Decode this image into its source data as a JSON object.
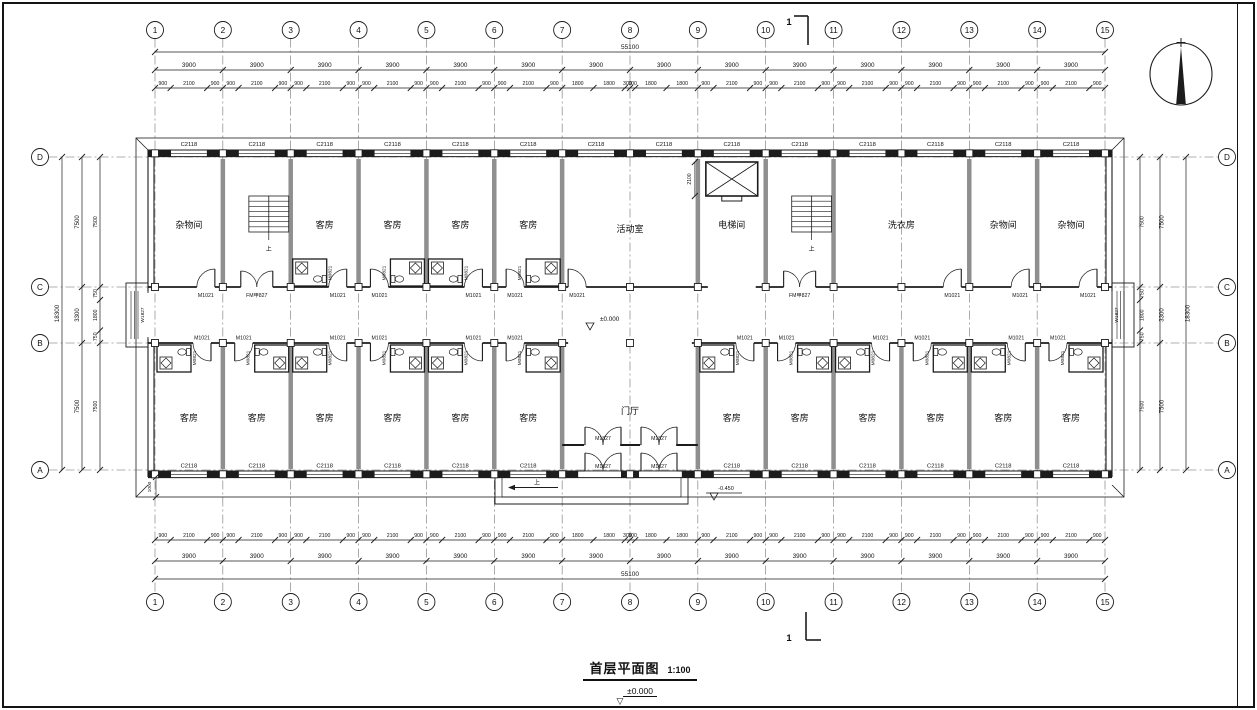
{
  "titleblock": {
    "title": "首层平面图",
    "scale": "1:100",
    "level": "±0.000"
  },
  "icons": {
    "level_marker": "▽",
    "north_arrow": "north-compass"
  },
  "plan": {
    "grid": {
      "cols": [
        "1",
        "2",
        "3",
        "4",
        "5",
        "6",
        "7",
        "8",
        "9",
        "10",
        "11",
        "12",
        "13",
        "14",
        "15"
      ],
      "rows": [
        "D",
        "C",
        "B",
        "A"
      ]
    },
    "tags": {
      "window": "C2118",
      "end_window": "W1827",
      "room_door": "M1021",
      "bath_door": "M0821",
      "fire_door": "FM甲827",
      "entry_door": "M1827"
    },
    "levels": {
      "corridor": "±0.000",
      "entrance": "-0.450"
    },
    "annotations": {
      "stair_up": "上",
      "ramp_up": "上",
      "elevator_dim": "2100",
      "apron_dim": "1000",
      "section_mark": "1"
    },
    "rooms": {
      "top": [
        {
          "name": "杂物间",
          "from": 1,
          "to": 2
        },
        {
          "name": "",
          "from": 2,
          "to": 3,
          "stair": true
        },
        {
          "name": "客房",
          "from": 3,
          "to": 4,
          "bath": "L"
        },
        {
          "name": "客房",
          "from": 4,
          "to": 5,
          "bath": "R"
        },
        {
          "name": "客房",
          "from": 5,
          "to": 6,
          "bath": "L"
        },
        {
          "name": "客房",
          "from": 6,
          "to": 7,
          "bath": "R"
        },
        {
          "name": "活动室",
          "from": 7,
          "to": 9
        },
        {
          "name": "电梯间",
          "from": 9,
          "to": 10,
          "elevator": true
        },
        {
          "name": "",
          "from": 10,
          "to": 11,
          "stair": true
        },
        {
          "name": "洗衣房",
          "from": 11,
          "to": 13
        },
        {
          "name": "杂物间",
          "from": 13,
          "to": 14
        },
        {
          "name": "杂物间",
          "from": 14,
          "to": 15
        }
      ],
      "bottom": [
        {
          "name": "客房",
          "from": 1,
          "to": 2,
          "bath": "L"
        },
        {
          "name": "客房",
          "from": 2,
          "to": 3,
          "bath": "R"
        },
        {
          "name": "客房",
          "from": 3,
          "to": 4,
          "bath": "L"
        },
        {
          "name": "客房",
          "from": 4,
          "to": 5,
          "bath": "R"
        },
        {
          "name": "客房",
          "from": 5,
          "to": 6,
          "bath": "L"
        },
        {
          "name": "客房",
          "from": 6,
          "to": 7,
          "bath": "R"
        },
        {
          "name": "门厅",
          "from": 7,
          "to": 9,
          "hall": true
        },
        {
          "name": "客房",
          "from": 9,
          "to": 10,
          "bath": "L"
        },
        {
          "name": "客房",
          "from": 10,
          "to": 11,
          "bath": "R"
        },
        {
          "name": "客房",
          "from": 11,
          "to": 12,
          "bath": "L"
        },
        {
          "name": "客房",
          "from": 12,
          "to": 13,
          "bath": "R"
        },
        {
          "name": "客房",
          "from": 13,
          "to": 14,
          "bath": "L"
        },
        {
          "name": "客房",
          "from": 14,
          "to": 15,
          "bath": "R"
        }
      ]
    },
    "dims": {
      "top": {
        "overall": "55100",
        "bays": [
          "3900",
          "3900",
          "3900",
          "3900",
          "3900",
          "3900",
          "3900",
          "3900",
          "3900",
          "3900",
          "3900",
          "3900",
          "3900",
          "3900"
        ],
        "subs": [
          [
            "900",
            "2100",
            "900"
          ],
          [
            "900",
            "2100",
            "900"
          ],
          [
            "900",
            "2100",
            "900"
          ],
          [
            "900",
            "2100",
            "900"
          ],
          [
            "900",
            "2100",
            "900"
          ],
          [
            "900",
            "2100",
            "900"
          ],
          [
            "1800",
            "1800",
            "300"
          ],
          [
            "300",
            "1800",
            "1800"
          ],
          [
            "900",
            "2100",
            "900"
          ],
          [
            "900",
            "2100",
            "900"
          ],
          [
            "900",
            "2100",
            "900"
          ],
          [
            "900",
            "2100",
            "900"
          ],
          [
            "900",
            "2100",
            "900"
          ],
          [
            "900",
            "2100",
            "900"
          ]
        ]
      },
      "bottom": {
        "overall": "55100",
        "bays": [
          "3900",
          "3900",
          "3900",
          "3900",
          "3900",
          "3900",
          "3900",
          "3900",
          "3900",
          "3900",
          "3900",
          "3900",
          "3900",
          "3900"
        ],
        "subs": [
          [
            "900",
            "2100",
            "900"
          ],
          [
            "900",
            "2100",
            "900"
          ],
          [
            "900",
            "2100",
            "900"
          ],
          [
            "900",
            "2100",
            "900"
          ],
          [
            "900",
            "2100",
            "900"
          ],
          [
            "900",
            "2100",
            "900"
          ],
          [
            "1800",
            "1800",
            "300"
          ],
          [
            "300",
            "1800",
            "1800"
          ],
          [
            "900",
            "2100",
            "900"
          ],
          [
            "900",
            "2100",
            "900"
          ],
          [
            "900",
            "2100",
            "900"
          ],
          [
            "900",
            "2100",
            "900"
          ],
          [
            "900",
            "2100",
            "900"
          ],
          [
            "900",
            "2100",
            "900"
          ]
        ]
      },
      "left": {
        "overall": "18300",
        "majors": [
          "7500",
          "3300",
          "7500"
        ],
        "subs": [
          "7500",
          "750",
          "1800",
          "750",
          "7500"
        ]
      },
      "right": {
        "overall": "18300",
        "majors": [
          "7500",
          "3300",
          "7500"
        ],
        "subs": [
          "7500",
          "750",
          "1800",
          "750",
          "7500"
        ]
      }
    }
  }
}
